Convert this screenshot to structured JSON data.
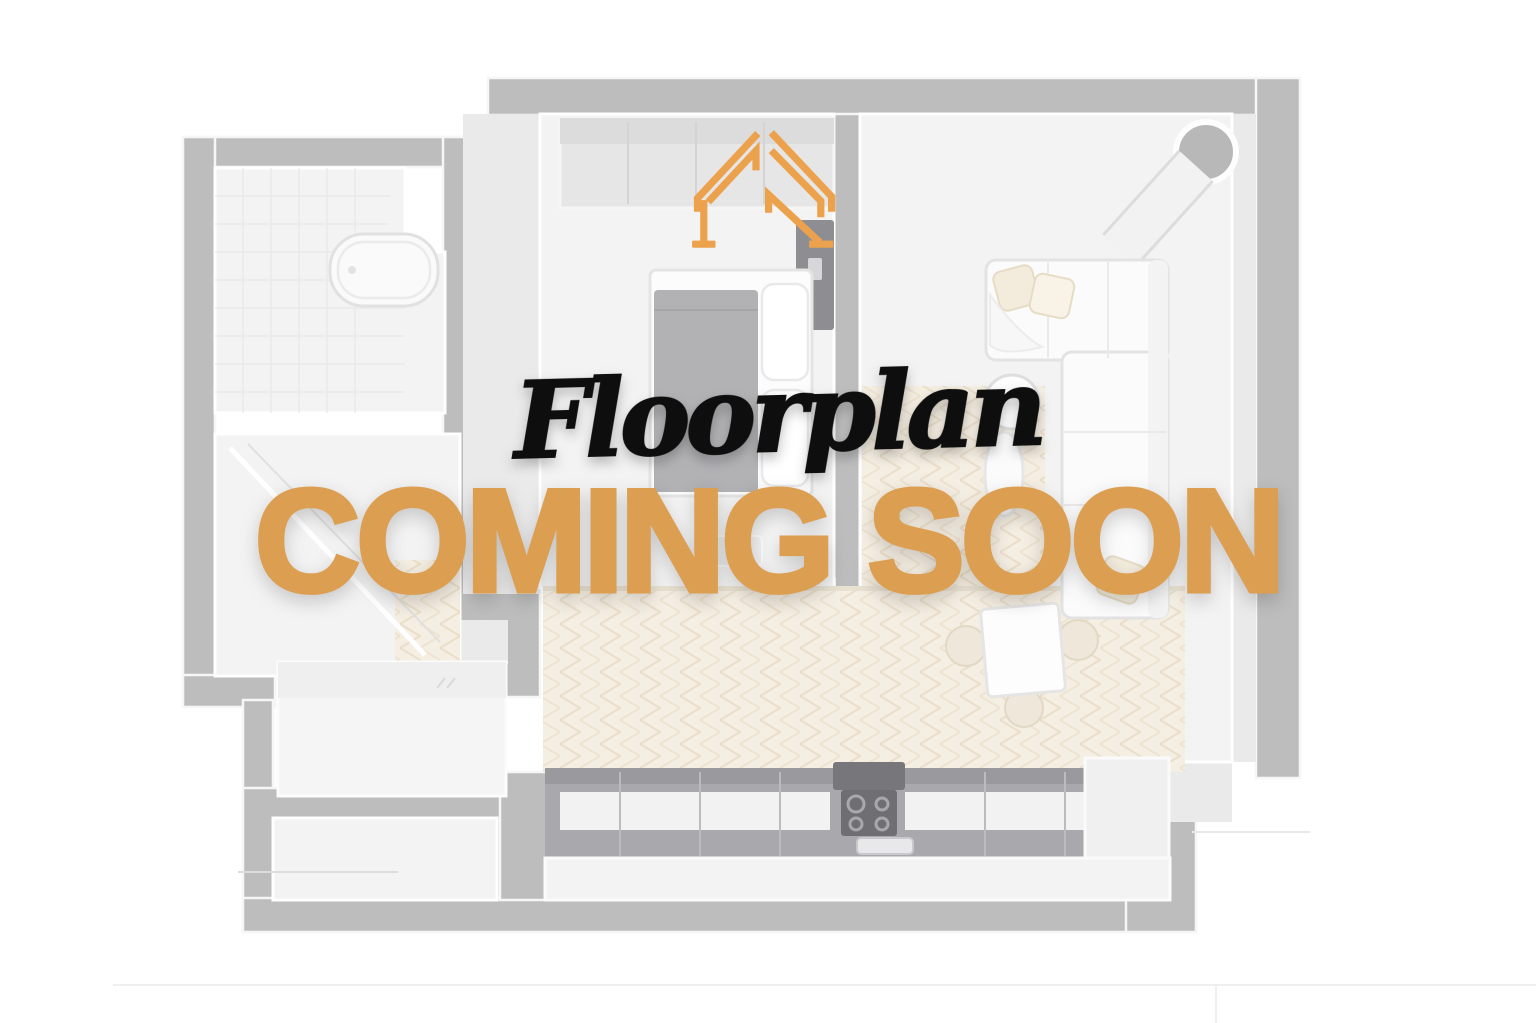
{
  "page": {
    "background": "#FFFFFF"
  },
  "placeholder": {
    "logo_icon": "roof-truss-icon",
    "logo_color": "#ECA24D",
    "script_title": "Floorplan",
    "script_title_color": "#0E0E0E",
    "headline": "COMING SOON",
    "headline_color": "#DC9E50"
  },
  "floorplan": {
    "wall_color": "#BDBDBD",
    "room_fill": "#F3F3F3",
    "wood_floor_color": "#F5EEE2",
    "wood_floor_line_color": "#E8DCC6",
    "counter_dark_color": "#A9A9AD",
    "furniture_items": [
      "bathtub",
      "shower",
      "bed",
      "wardrobe",
      "tv-unit",
      "sofa",
      "side-table",
      "floor-lamp",
      "column-pipe",
      "dining-table",
      "dining-chairs",
      "kitchen-counter",
      "stove",
      "storage-room",
      "platform"
    ]
  }
}
